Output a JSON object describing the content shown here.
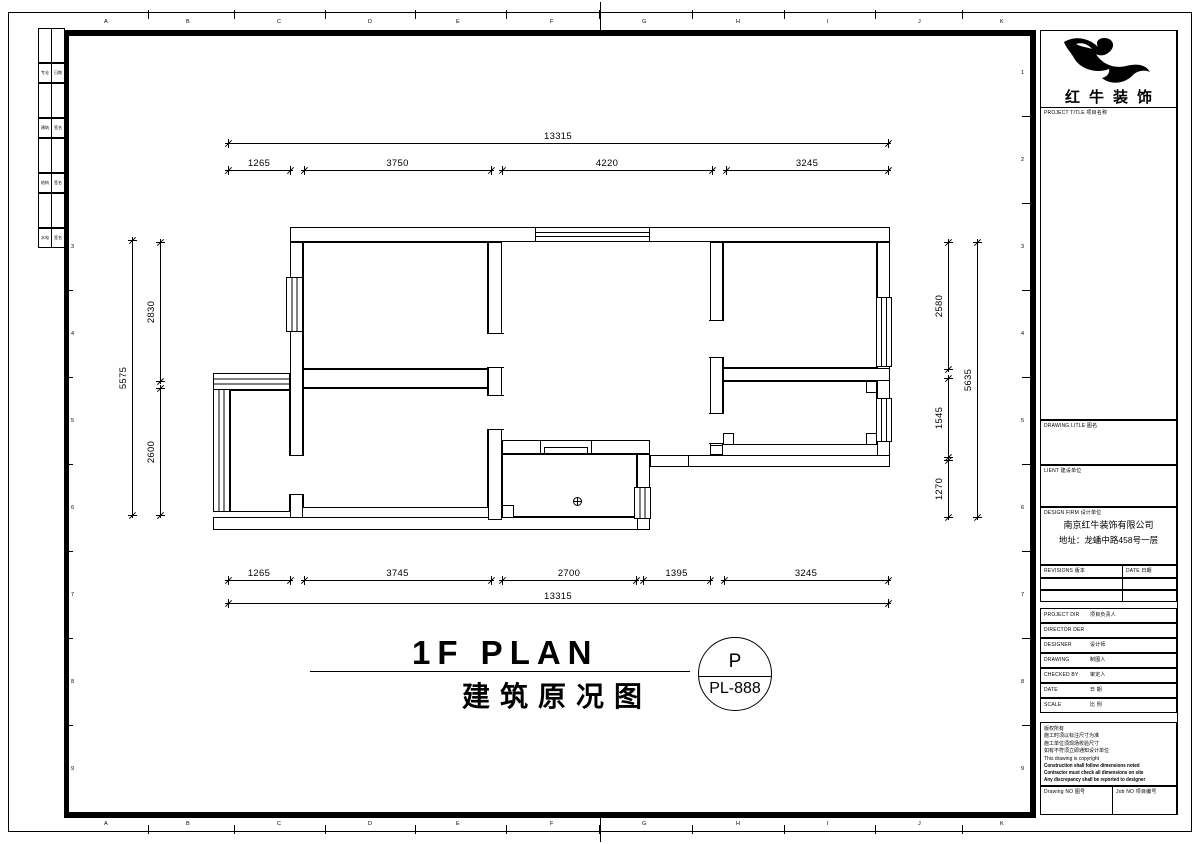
{
  "sheet": {
    "company": "红牛装饰",
    "title_en": "1F PLAN",
    "title_cn": "建筑原况图",
    "stamp": {
      "top": "P",
      "bottom": "PL-888"
    },
    "grid_letters": [
      "A",
      "B",
      "C",
      "D",
      "E",
      "F",
      "G",
      "H",
      "I",
      "J",
      "K"
    ],
    "grid_numbers_right": [
      "1",
      "2",
      "3",
      "4",
      "5",
      "6",
      "7",
      "8",
      "9"
    ],
    "grid_numbers_left": [
      "3",
      "4",
      "5",
      "6",
      "7",
      "8",
      "9"
    ]
  },
  "sign_table": {
    "rows": [
      [
        "专业",
        "日期"
      ],
      [
        "建筑",
        "签名"
      ],
      [
        "结构",
        "签名"
      ],
      [
        "水电",
        "签名"
      ]
    ]
  },
  "title_block": {
    "project_label": "PROJECT TITLE  项目名称",
    "drawing_label": "DRAWING LITLE  图名",
    "client_label": "LIENT  建设单位",
    "design_firm_label": "DESIGN FIRM  设计单位",
    "firm_name": "南京红牛装饰有限公司",
    "firm_address": "地址：龙蟠中路458号一层",
    "revisions_label": "REVISIONS 版本",
    "rev_date_label": "DATE 日期",
    "rows": [
      {
        "en": "PROJECT DIR",
        "cn": "项目负责人"
      },
      {
        "en": "DIRECTOR DER",
        "cn": ""
      },
      {
        "en": "DESIGNER",
        "cn": "设计师"
      },
      {
        "en": "DRAWING",
        "cn": "制图人"
      },
      {
        "en": "CHECKED BY",
        "cn": "审定人"
      },
      {
        "en": "DATE",
        "cn": "日 期"
      },
      {
        "en": "SCALE",
        "cn": "比 例"
      }
    ],
    "notes": [
      "版权所有",
      "施工时须以标注尺寸为准",
      "施工单位须现场校验尺寸",
      "如有不符须立即通知设计单位",
      "This drawing is copyright"
    ],
    "notes_bold": [
      "Construction shall follow dimensions noted",
      "Contractor must check all dimensions on site",
      "Any discrepancy shall be reported to designer"
    ],
    "drawing_no_label": "Drawing NO  图号",
    "job_no_label": "Job NO  项目编号"
  },
  "dimensions": {
    "horizontal": [
      {
        "x1": 228,
        "x2": 888,
        "y": 143,
        "label": "13315"
      },
      {
        "x1": 228,
        "x2": 290,
        "y": 170,
        "label": "1265"
      },
      {
        "x1": 304,
        "x2": 491,
        "y": 170,
        "label": "3750"
      },
      {
        "x1": 502,
        "x2": 712,
        "y": 170,
        "label": "4220"
      },
      {
        "x1": 726,
        "x2": 888,
        "y": 170,
        "label": "3245"
      },
      {
        "x1": 228,
        "x2": 290,
        "y": 580,
        "label": "1265"
      },
      {
        "x1": 304,
        "x2": 491,
        "y": 580,
        "label": "3745"
      },
      {
        "x1": 502,
        "x2": 636,
        "y": 580,
        "label": "2700"
      },
      {
        "x1": 643,
        "x2": 710,
        "y": 580,
        "label": "1395"
      },
      {
        "x1": 724,
        "x2": 888,
        "y": 580,
        "label": "3245"
      },
      {
        "x1": 228,
        "x2": 888,
        "y": 603,
        "label": "13315"
      }
    ],
    "vertical": [
      {
        "y1": 240,
        "y2": 515,
        "x": 132,
        "label": "5575"
      },
      {
        "y1": 242,
        "y2": 381,
        "x": 160,
        "label": "2830"
      },
      {
        "y1": 388,
        "y2": 515,
        "x": 160,
        "label": "2600"
      },
      {
        "y1": 242,
        "y2": 369,
        "x": 948,
        "label": "2580"
      },
      {
        "y1": 378,
        "y2": 457,
        "x": 948,
        "label": "1545"
      },
      {
        "y1": 460,
        "y2": 517,
        "x": 948,
        "label": "1270"
      },
      {
        "y1": 242,
        "y2": 517,
        "x": 977,
        "label": "5635"
      }
    ]
  },
  "plan": {
    "walls": [
      {
        "x": 290,
        "y": 227,
        "w": 600,
        "h": 15
      },
      {
        "x": 290,
        "y": 242,
        "w": 13,
        "h": 278
      },
      {
        "x": 877,
        "y": 242,
        "w": 13,
        "h": 225
      },
      {
        "x": 650,
        "y": 455,
        "w": 240,
        "h": 12
      },
      {
        "x": 213,
        "y": 517,
        "w": 437,
        "h": 13
      },
      {
        "x": 303,
        "y": 369,
        "w": 185,
        "h": 19
      },
      {
        "x": 488,
        "y": 242,
        "w": 14,
        "h": 278
      },
      {
        "x": 710,
        "y": 242,
        "w": 13,
        "h": 213
      },
      {
        "x": 723,
        "y": 368,
        "w": 167,
        "h": 13
      },
      {
        "x": 502,
        "y": 440,
        "w": 148,
        "h": 14
      },
      {
        "x": 637,
        "y": 454,
        "w": 13,
        "h": 76
      },
      {
        "x": 710,
        "y": 445,
        "w": 13,
        "h": 10
      }
    ],
    "rooms": [
      {
        "x": 303,
        "y": 242,
        "w": 185,
        "h": 127
      },
      {
        "x": 303,
        "y": 388,
        "w": 185,
        "h": 120
      },
      {
        "x": 723,
        "y": 242,
        "w": 154,
        "h": 126
      },
      {
        "x": 723,
        "y": 381,
        "w": 154,
        "h": 64
      },
      {
        "x": 502,
        "y": 454,
        "w": 135,
        "h": 63
      },
      {
        "x": 230,
        "y": 390,
        "w": 60,
        "h": 122
      }
    ],
    "windows": [
      {
        "x": 286,
        "y": 277,
        "w": 17,
        "h": 55,
        "dir": "v"
      },
      {
        "x": 535,
        "y": 227,
        "w": 115,
        "h": 15,
        "dir": "h"
      },
      {
        "x": 213,
        "y": 375,
        "w": 17,
        "h": 137,
        "dir": "v"
      },
      {
        "x": 213,
        "y": 373,
        "w": 77,
        "h": 17,
        "dir": "h"
      },
      {
        "x": 876,
        "y": 297,
        "w": 16,
        "h": 70,
        "dir": "v"
      },
      {
        "x": 876,
        "y": 398,
        "w": 16,
        "h": 44,
        "dir": "v"
      },
      {
        "x": 634,
        "y": 487,
        "w": 17,
        "h": 32,
        "dir": "v"
      }
    ],
    "gaps": [
      {
        "x": 487,
        "y": 333,
        "w": 17,
        "h": 35
      },
      {
        "x": 487,
        "y": 395,
        "w": 17,
        "h": 35
      },
      {
        "x": 709,
        "y": 320,
        "w": 15,
        "h": 38
      },
      {
        "x": 709,
        "y": 413,
        "w": 15,
        "h": 31
      },
      {
        "x": 289,
        "y": 455,
        "w": 15,
        "h": 40
      },
      {
        "x": 540,
        "y": 441,
        "w": 52,
        "h": 12
      }
    ],
    "piers": [
      {
        "x": 502,
        "y": 505,
        "w": 12,
        "h": 13
      },
      {
        "x": 723,
        "y": 433,
        "w": 11,
        "h": 12
      },
      {
        "x": 866,
        "y": 433,
        "w": 11,
        "h": 12
      },
      {
        "x": 866,
        "y": 381,
        "w": 11,
        "h": 12
      }
    ],
    "extras": [
      {
        "x": 544,
        "y": 447,
        "w": 44,
        "h": 7,
        "type": "box"
      },
      {
        "x": 688,
        "y": 455,
        "w": 1,
        "h": 12,
        "type": "line"
      }
    ],
    "drain": {
      "x": 573,
      "y": 497
    }
  }
}
